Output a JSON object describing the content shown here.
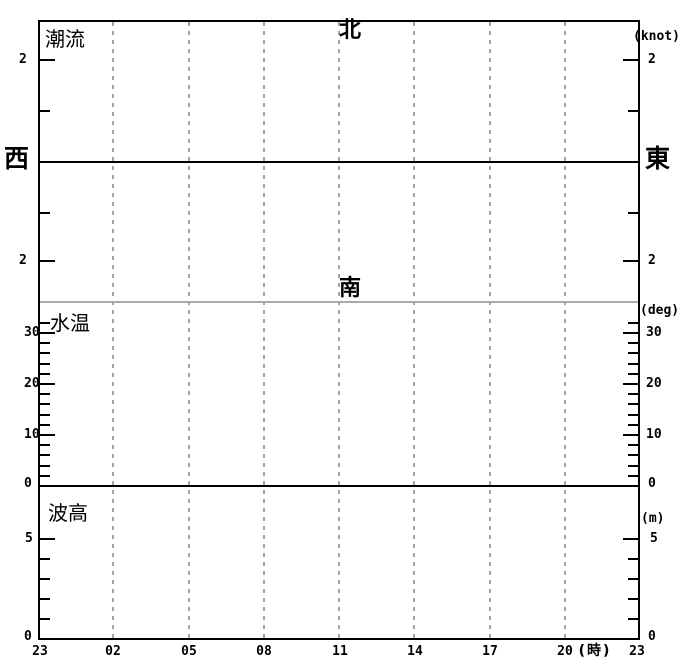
{
  "colors": {
    "background": "#ffffff",
    "axis": "#000000",
    "gridline": "#a3a3a3",
    "divider": "#aaaaaa",
    "text": "#000000"
  },
  "chart_data": [
    {
      "type": "line",
      "panel_title": "潮流",
      "unit": "(knot)",
      "direction_labels": {
        "up": "北",
        "down": "南",
        "left": "西",
        "right": "東"
      },
      "y_axis": {
        "labeled_ticks": [
          2,
          -2
        ],
        "tick_values": [
          2,
          1,
          -1,
          -2
        ],
        "zero_line": true,
        "grid": "off"
      },
      "x_axis": {
        "tick_labels": [
          "23",
          "02",
          "05",
          "08",
          "11",
          "14",
          "17",
          "20",
          "23"
        ],
        "interval_hours": 3,
        "axis_label": "(時)",
        "grid": "dashed-vertical"
      },
      "series": []
    },
    {
      "type": "line",
      "panel_title": "水温",
      "unit": "(deg)",
      "y_axis": {
        "labeled_ticks": [
          30,
          20,
          10,
          0
        ],
        "minor_step": 2,
        "ylim": [
          0,
          36
        ]
      },
      "series": []
    },
    {
      "type": "line",
      "panel_title": "波高",
      "unit": "(m)",
      "y_axis": {
        "labeled_ticks": [
          5,
          0
        ],
        "minor_step": 1,
        "ylim": [
          0,
          7.7
        ]
      },
      "series": []
    }
  ],
  "render": {
    "plot": {
      "left": 38,
      "top": 20,
      "right": 640,
      "bottom": 640
    },
    "gridlines_x": [
      113,
      189,
      264,
      339,
      414,
      490,
      565
    ],
    "hlines": [
      {
        "name": "current-zero-line",
        "y": 162,
        "color": "#000000"
      },
      {
        "name": "panel-divider-line",
        "y": 302,
        "color": "#aaaaaa"
      },
      {
        "name": "watertemp-zero-line",
        "y": 486,
        "color": "#000000"
      }
    ],
    "ticks": [
      {
        "y": 60,
        "major": true
      },
      {
        "y": 111
      },
      {
        "y": 213
      },
      {
        "y": 261,
        "major": true
      },
      {
        "y": 323
      },
      {
        "y": 333,
        "major": true
      },
      {
        "y": 343
      },
      {
        "y": 353
      },
      {
        "y": 364
      },
      {
        "y": 374
      },
      {
        "y": 384,
        "major": true
      },
      {
        "y": 394
      },
      {
        "y": 404
      },
      {
        "y": 415
      },
      {
        "y": 425
      },
      {
        "y": 435,
        "major": true
      },
      {
        "y": 445
      },
      {
        "y": 455
      },
      {
        "y": 466
      },
      {
        "y": 476
      },
      {
        "y": 539,
        "major": true
      },
      {
        "y": 559
      },
      {
        "y": 579
      },
      {
        "y": 599
      },
      {
        "y": 619
      }
    ],
    "labels": [
      {
        "name": "panel-title-current",
        "text": "潮流",
        "x": 45,
        "y": 29,
        "fs": 20,
        "bold": false,
        "cjk": true
      },
      {
        "name": "direction-north-label",
        "text": "北",
        "cx": 350,
        "y": 20,
        "fs": 22,
        "bold": true,
        "cjk": true
      },
      {
        "name": "unit-knot-label",
        "text": "(knot)",
        "x": 633,
        "y": 30,
        "fs": 13,
        "bold": true
      },
      {
        "name": "current-2n-left",
        "text": "2",
        "x": 19,
        "y": 53,
        "fs": 13,
        "bold": true
      },
      {
        "name": "current-2n-right",
        "text": "2",
        "x": 648,
        "y": 53,
        "fs": 13,
        "bold": true
      },
      {
        "name": "direction-west-label",
        "text": "西",
        "x": 4,
        "y": 146,
        "fs": 25,
        "bold": true,
        "cjk": true
      },
      {
        "name": "direction-east-label",
        "text": "東",
        "x": 645,
        "y": 146,
        "fs": 25,
        "bold": true,
        "cjk": true
      },
      {
        "name": "current-2s-left",
        "text": "2",
        "x": 19,
        "y": 254,
        "fs": 13,
        "bold": true
      },
      {
        "name": "current-2s-right",
        "text": "2",
        "x": 648,
        "y": 254,
        "fs": 13,
        "bold": true
      },
      {
        "name": "direction-south-label",
        "text": "南",
        "cx": 350,
        "y": 278,
        "fs": 22,
        "bold": true,
        "cjk": true
      },
      {
        "name": "panel-title-watertemp",
        "text": "水温",
        "x": 50,
        "y": 313,
        "fs": 20,
        "bold": false,
        "cjk": true
      },
      {
        "name": "unit-deg-label",
        "text": "(deg)",
        "x": 640,
        "y": 304,
        "fs": 13,
        "bold": true
      },
      {
        "name": "temp-30-left",
        "text": "30",
        "x": 24,
        "y": 326,
        "fs": 13,
        "bold": true
      },
      {
        "name": "temp-30-right",
        "text": "30",
        "x": 646,
        "y": 326,
        "fs": 13,
        "bold": true
      },
      {
        "name": "temp-20-left",
        "text": "20",
        "x": 24,
        "y": 377,
        "fs": 13,
        "bold": true
      },
      {
        "name": "temp-20-right",
        "text": "20",
        "x": 646,
        "y": 377,
        "fs": 13,
        "bold": true
      },
      {
        "name": "temp-10-left",
        "text": "10",
        "x": 24,
        "y": 428,
        "fs": 13,
        "bold": true
      },
      {
        "name": "temp-10-right",
        "text": "10",
        "x": 646,
        "y": 428,
        "fs": 13,
        "bold": true
      },
      {
        "name": "temp-0-left",
        "text": "0",
        "x": 24,
        "y": 477,
        "fs": 13,
        "bold": true
      },
      {
        "name": "temp-0-right",
        "text": "0",
        "x": 648,
        "y": 477,
        "fs": 13,
        "bold": true
      },
      {
        "name": "panel-title-waveheight",
        "text": "波高",
        "x": 48,
        "y": 503,
        "fs": 20,
        "bold": false,
        "cjk": true
      },
      {
        "name": "unit-m-label",
        "text": "(m)",
        "x": 641,
        "y": 512,
        "fs": 13,
        "bold": true
      },
      {
        "name": "wave-5-left",
        "text": "5",
        "x": 25,
        "y": 532,
        "fs": 13,
        "bold": true
      },
      {
        "name": "wave-5-right",
        "text": "5",
        "x": 650,
        "y": 532,
        "fs": 13,
        "bold": true
      },
      {
        "name": "wave-0-left",
        "text": "0",
        "x": 24,
        "y": 630,
        "fs": 13,
        "bold": true
      },
      {
        "name": "wave-0-right",
        "text": "0",
        "x": 648,
        "y": 630,
        "fs": 13,
        "bold": true
      },
      {
        "name": "xtick-23-start",
        "text": "23",
        "cx": 40,
        "y": 645,
        "fs": 13,
        "bold": true
      },
      {
        "name": "xtick-02",
        "text": "02",
        "cx": 113,
        "y": 645,
        "fs": 13,
        "bold": true
      },
      {
        "name": "xtick-05",
        "text": "05",
        "cx": 189,
        "y": 645,
        "fs": 13,
        "bold": true
      },
      {
        "name": "xtick-08",
        "text": "08",
        "cx": 264,
        "y": 645,
        "fs": 13,
        "bold": true
      },
      {
        "name": "xtick-11",
        "text": "11",
        "cx": 340,
        "y": 645,
        "fs": 13,
        "bold": true
      },
      {
        "name": "xtick-14",
        "text": "14",
        "cx": 415,
        "y": 645,
        "fs": 13,
        "bold": true
      },
      {
        "name": "xtick-17",
        "text": "17",
        "cx": 490,
        "y": 645,
        "fs": 13,
        "bold": true
      },
      {
        "name": "xtick-20",
        "text": "20",
        "cx": 565,
        "y": 645,
        "fs": 13,
        "bold": true
      },
      {
        "name": "xaxis-hour-unit",
        "text": "(時)",
        "cx": 595,
        "y": 644,
        "fs": 14,
        "bold": true,
        "cjk": true,
        "ls": 2
      },
      {
        "name": "xtick-23-end",
        "text": "23",
        "cx": 637,
        "y": 645,
        "fs": 13,
        "bold": true
      }
    ]
  }
}
